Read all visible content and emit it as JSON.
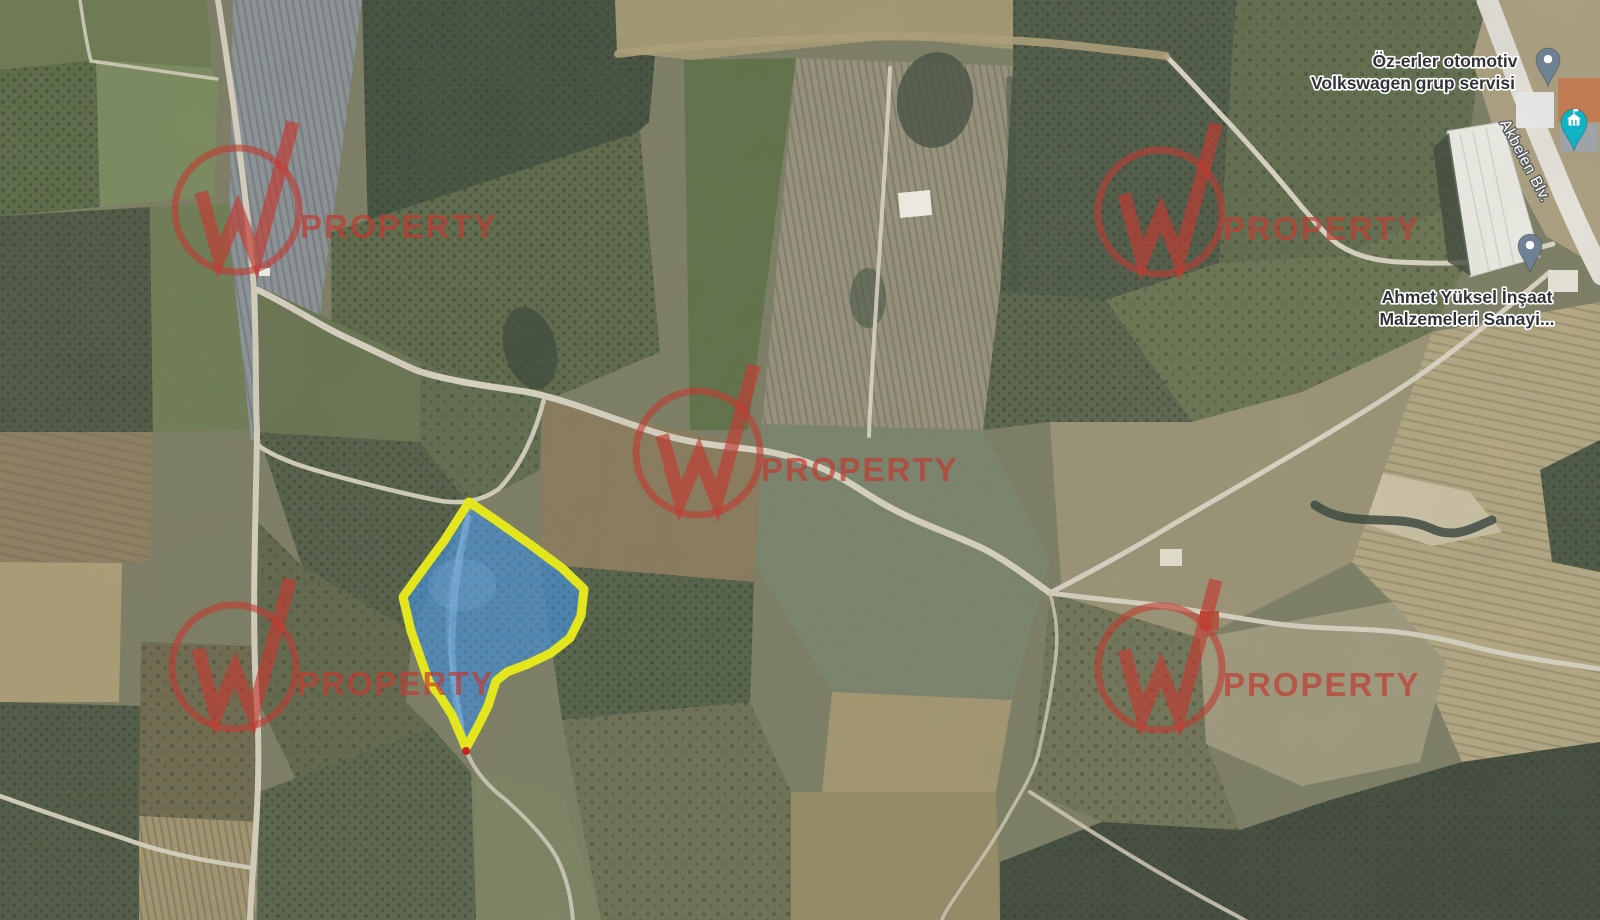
{
  "map": {
    "canvas": {
      "width": 1600,
      "height": 920
    },
    "base_color": "#7b7c62",
    "poi_labels": [
      {
        "id": "ozerler-otomotiv",
        "lines": [
          {
            "text": "Öz-erler otomotiv",
            "x": 1445,
            "y": 67
          },
          {
            "text": "Volkswagen grup servisi",
            "x": 1413,
            "y": 89
          }
        ]
      },
      {
        "id": "ahmet-yuksel",
        "lines": [
          {
            "text": "Ahmet Yüksel İnşaat",
            "x": 1467,
            "y": 303
          },
          {
            "text": "Malzemeleri Sanayi...",
            "x": 1467,
            "y": 325
          }
        ]
      }
    ],
    "label_style": {
      "poi_color": "#2f3337",
      "poi_halo": "#ffffff",
      "font_size": 17.5
    },
    "road_label": {
      "text": "Akbelen Blv.",
      "x": 1521,
      "y": 163,
      "rotation": 62,
      "color": "#ffffff",
      "halo": "#575c60",
      "font_size": 15.5
    },
    "pins": [
      {
        "id": "pin-ozerler",
        "x": 1548,
        "y": 60,
        "color": "#6f8193",
        "scale": 0.92
      },
      {
        "id": "pin-ahmet",
        "x": 1530,
        "y": 246,
        "color": "#6f8193",
        "scale": 0.92
      }
    ],
    "landmark_pin": {
      "id": "pin-landmark",
      "x": 1574,
      "y": 122,
      "color": "#10b3c4",
      "glyph": "building-flag-icon"
    },
    "watermark": {
      "text": "PROPERTY",
      "color": "#c23b32",
      "circle_radius": 62,
      "circle_stroke": 7,
      "w_stroke": 13.5,
      "w_path": "M-36,-18 L-18,48 L1,2 L19,48 L56,-88",
      "text_dx": 63,
      "text_dy": 28,
      "font_size": 33,
      "opacity_circle": 0.6,
      "opacity_w": 0.66,
      "opacity_text": 0.7,
      "positions": [
        [
          237,
          210
        ],
        [
          1160,
          212
        ],
        [
          698,
          453
        ],
        [
          234,
          667
        ],
        [
          1160,
          668
        ]
      ]
    },
    "parcel": {
      "points": "469,502 497,521 531,545 562,568 584,589 581,616 570,638 551,653 528,664 507,672 496,681 488,706 477,728 466,748 452,715 440,696 429,682 411,631 403,597 421,572 444,541",
      "fill": "#4a8bc4",
      "fill_opacity": 0.8,
      "stroke": "#e4e61d",
      "stroke_width": 9,
      "streak_path": "M468,518 C459,556 451,606 452,656 C454,694 459,722 464,744",
      "streak_color": "#8fc0e8",
      "blob": {
        "cx": 462,
        "cy": 585,
        "rx": 34,
        "ry": 26,
        "color": "#7fb0dc"
      },
      "tip_dot": {
        "x": 466,
        "y": 751,
        "r": 4,
        "color": "#c52222"
      }
    },
    "fields": [
      {
        "pts": "0,0 207,0 212,68 96,60 0,70",
        "fill": "#6a784f"
      },
      {
        "pts": "0,70 96,60 100,207 0,216",
        "fill": "#5a6845",
        "tex": "dotsA"
      },
      {
        "pts": "96,60 212,68 218,82 214,196 100,207",
        "fill": "#79895c"
      },
      {
        "pts": "0,216 150,207 153,432 0,432",
        "fill": "#4b5641",
        "tex": "dotsA"
      },
      {
        "pts": "150,207 252,202 256,430 153,432",
        "fill": "#6d7b52"
      },
      {
        "pts": "233,0 362,0 331,230 303,442 251,440 229,230",
        "fill": "#8b9298",
        "tex": "rowsV"
      },
      {
        "pts": "362,0 660,0 649,122 556,206 449,243 368,231",
        "fill": "#414e3c",
        "tex": "dotsA"
      },
      {
        "pts": "331,232 640,132 660,352 520,412 420,432 332,348",
        "fill": "#5b6747",
        "tex": "dotsA"
      },
      {
        "pts": "615,0 1162,0 1162,72 1100,58 900,38 692,60 617,52",
        "fill": "#a29772"
      },
      {
        "pts": "684,60 796,58 748,430 690,430",
        "fill": "#5d7046"
      },
      {
        "pts": "796,58 1013,66 1000,292 983,430 762,424",
        "fill": "#97917a",
        "tex": "rowsV"
      },
      {
        "pts": "1013,0 1236,0 1219,263 1106,300 1000,292 1013,66",
        "fill": "#4c5844",
        "tex": "dotsA"
      },
      {
        "pts": "1236,0 1488,0 1461,200 1346,256 1219,263",
        "fill": "#5e6a4b",
        "tex": "dotsB"
      },
      {
        "pts": "1488,0 1600,0 1600,268 1546,236 1500,150 1472,60",
        "fill": "#ab9f7f"
      },
      {
        "pts": "1219,263 1346,256 1461,200 1492,212 1432,332 1302,392 1192,422 1106,300",
        "fill": "#687350",
        "tex": "dotsB"
      },
      {
        "pts": "1432,332 1600,302 1600,742 1462,762 1392,602 1352,562",
        "fill": "#b4a781",
        "tex": "rowsH"
      },
      {
        "pts": "1368,470 1470,492 1502,532 1432,546 1360,522",
        "fill": "#cdc3a6"
      },
      {
        "pts": "1050,422 1192,422 1302,392 1432,332 1352,562 1200,638 1062,596",
        "fill": "#9a9274"
      },
      {
        "pts": "762,424 983,430 1050,560 1012,700 832,692 754,562",
        "fill": "#79826a"
      },
      {
        "pts": "832,692 1012,700 996,792 822,792",
        "fill": "#a3966f"
      },
      {
        "pts": "542,400 762,448 754,582 540,564",
        "fill": "#89795a"
      },
      {
        "pts": "540,564 754,582 750,702 562,720",
        "fill": "#525f47",
        "tex": "dotsA"
      },
      {
        "pts": "258,432 420,442 470,506 412,632 302,566",
        "fill": "#515c46",
        "tex": "dotsA"
      },
      {
        "pts": "256,520 302,566 412,632 406,702 432,728 302,792 259,702",
        "fill": "#5f6549",
        "tex": "dotsB"
      },
      {
        "pts": "0,432 153,432 149,562 0,562",
        "fill": "#8d7d5f",
        "tex": "rowsH"
      },
      {
        "pts": "0,562 122,563 119,702 0,702",
        "fill": "#ab9c74"
      },
      {
        "pts": "0,702 141,706 139,920 0,920",
        "fill": "#4d5742",
        "tex": "dotsA"
      },
      {
        "pts": "141,642 258,646 259,822 139,816",
        "fill": "#6d684d",
        "tex": "dotsB"
      },
      {
        "pts": "139,816 259,822 256,920 139,920",
        "fill": "#a3956e",
        "tex": "rowsV"
      },
      {
        "pts": "259,792 432,728 471,772 476,920 257,920",
        "fill": "#57624a",
        "tex": "dotsA"
      },
      {
        "pts": "476,772 562,792 601,920 476,920",
        "fill": "#7b8260"
      },
      {
        "pts": "562,720 750,702 791,792 791,920 601,920",
        "fill": "#6b7052",
        "tex": "dotsB"
      },
      {
        "pts": "791,792 996,792 1000,920 791,920",
        "fill": "#958a64"
      },
      {
        "pts": "1050,593 1200,638 1206,742 1240,830 1102,822 1028,790 1040,700",
        "fill": "#6e7355",
        "tex": "dotsB"
      },
      {
        "pts": "1102,822 1240,830 1330,800 1462,762 1600,742 1600,920 1000,920 1000,862",
        "fill": "#3e483a",
        "tex": "dotsA"
      },
      {
        "pts": "1200,638 1392,602 1446,662 1420,762 1302,786 1206,744",
        "fill": "#9e997c"
      },
      {
        "pts": "258,286 420,362 420,442 258,432",
        "fill": "#67724f"
      },
      {
        "pts": "420,362 542,400 540,470 470,506 420,442",
        "fill": "#5e6a4c",
        "tex": "dotsB"
      },
      {
        "pts": "1000,292 1106,300 1192,422 1050,422 983,430",
        "fill": "#57624a",
        "tex": "dotsA"
      },
      {
        "pts": "1540,470 1600,440 1600,572 1552,562",
        "fill": "#4a5542",
        "tex": "dotsA"
      }
    ],
    "roads": [
      {
        "d": "M218,0 C230,80 247,190 254,292 C257,360 255,396 257,430 C256,520 251,620 257,706 C262,795 252,862 250,920",
        "w": 6,
        "c": "#d7d1c0"
      },
      {
        "d": "M258,290 C295,308 322,327 347,338 C377,352 397,362 418,371 C456,383 497,387 527,392 C560,398 600,414 654,432 C700,447 736,446 770,452 C820,462 845,480 872,497 C910,521 946,531 982,548 C1006,560 1028,577 1050,593",
        "w": 6.5,
        "c": "#dad4c3"
      },
      {
        "d": "M544,399 C536,432 521,466 499,489 C481,501 461,506 431,499 C401,493 331,476 296,464 C277,457 266,451 259,446",
        "w": 4.5,
        "c": "#d5cfbd"
      },
      {
        "d": "M471,506 C461,545 449,580 448,618 C448,660 456,692 462,722 C465,738 466,745 466,750 C473,768 486,785 506,800 C526,818 546,838 557,858 C567,878 571,898 573,920",
        "w": 4,
        "c": "#d2ccba",
        "o": 0.9
      },
      {
        "d": "M1050,593 C1090,572 1122,555 1162,531 C1207,504 1262,473 1312,443 C1357,416 1402,389 1442,359 C1472,337 1512,304 1550,272",
        "w": 5,
        "c": "#dbd5c4"
      },
      {
        "d": "M1050,593 C1086,598 1121,601 1156,605 C1201,611 1241,619 1279,624 C1316,629 1351,628 1387,631 C1421,634 1451,641 1479,648 C1521,658 1561,663 1600,669",
        "w": 5,
        "c": "#d8d2c1"
      },
      {
        "d": "M1050,593 C1056,615 1058,632 1056,655 C1052,690 1046,720 1038,755 C1032,775 1024,788 1010,812 C995,840 975,868 960,890 C950,905 945,912 942,920",
        "w": 3.5,
        "c": "#cfc9b7",
        "o": 0.85
      },
      {
        "d": "M1030,792 C1082,826 1142,864 1202,897 C1227,911 1242,918 1254,926",
        "w": 4,
        "c": "#cfc8b5",
        "o": 0.9
      },
      {
        "d": "M1166,56 C1186,76 1206,99 1229,123 C1253,149 1279,179 1301,206 C1316,223 1326,236 1339,245 C1356,256 1376,261 1399,262 C1421,263 1446,264 1469,262 C1496,259 1526,251 1553,244",
        "w": 5,
        "c": "#dcd6c5"
      },
      {
        "d": "M1487,0 C1498,28 1510,60 1522,92 C1536,128 1550,160 1563,192 C1576,222 1588,248 1602,275",
        "w": 21,
        "c": "#e8e5dc"
      },
      {
        "d": "M890,68 C886,160 879,255 874,340 C872,375 870,406 869,436",
        "w": 4,
        "c": "#e0dac6",
        "o": 0.9
      },
      {
        "d": "M618,54 C680,46 762,40 852,37 C942,35 1032,40 1097,48 C1122,51 1147,53 1166,56",
        "w": 8,
        "c": "#ad9f77",
        "o": 0.9
      },
      {
        "d": "M80,0 C83,20 86,42 91,61 C131,67 176,73 217,79",
        "w": 3.5,
        "c": "#d5cfbd",
        "o": 0.9
      },
      {
        "d": "M0,796 C46,813 96,829 146,846 C186,858 221,863 253,868",
        "w": 4.5,
        "c": "#d6d0be"
      }
    ],
    "hedges": [
      {
        "d": "M1315,505 C1350,530 1395,512 1430,528 C1455,540 1472,528 1492,520",
        "w": 9,
        "c": "#36423a",
        "o": 0.85
      },
      {
        "d": "M1010,80 C1012,150 1014,220 1015,290",
        "w": 8,
        "c": "#44513f",
        "o": 0.55
      }
    ],
    "blobs": [
      {
        "cx": 530,
        "cy": 348,
        "rx": 26,
        "ry": 42,
        "rot": -15,
        "c": "#3a4636",
        "o": 0.8
      },
      {
        "cx": 935,
        "cy": 100,
        "rx": 38,
        "ry": 48,
        "rot": 8,
        "c": "#3c4839",
        "o": 0.75
      },
      {
        "cx": 868,
        "cy": 298,
        "rx": 18,
        "ry": 30,
        "rot": 0,
        "c": "#40503e",
        "o": 0.6
      }
    ],
    "buildings": [
      {
        "pts": "1447,131 1502,122 1540,257 1470,277",
        "fill": "#f0f0ea",
        "stroke": "#c9c9c0"
      },
      {
        "pts": "1433,148 1449,133 1471,276 1448,262",
        "fill": "#394436",
        "o": 0.8
      },
      {
        "pts": "1548,270 1578,270 1578,292 1548,292",
        "fill": "#e9e6da"
      },
      {
        "pts": "898,193 930,190 932,215 900,218",
        "fill": "#f3f1e8"
      },
      {
        "pts": "1160,549 1182,549 1182,566 1160,566",
        "fill": "#e6e2d2"
      },
      {
        "pts": "1200,611 1219,611 1219,630 1200,630",
        "fill": "#b2523b"
      },
      {
        "pts": "1516,92 1554,92 1554,128 1516,128",
        "fill": "#ececec"
      },
      {
        "pts": "1558,78 1600,78 1600,122 1558,122",
        "fill": "#c8794d"
      },
      {
        "pts": "1560,124 1598,124 1598,152 1560,152",
        "fill": "#9fa5ab"
      },
      {
        "pts": "259,268 270,268 270,276 259,276",
        "fill": "#f5f5f0"
      }
    ],
    "warehouse_ribs": [
      {
        "d": "M1460,134 L1489,271",
        "c": "#d8d8d0"
      },
      {
        "d": "M1473,131 L1501,268",
        "c": "#d8d8d0"
      },
      {
        "d": "M1486,128 L1514,264",
        "c": "#d8d8d0"
      }
    ]
  }
}
